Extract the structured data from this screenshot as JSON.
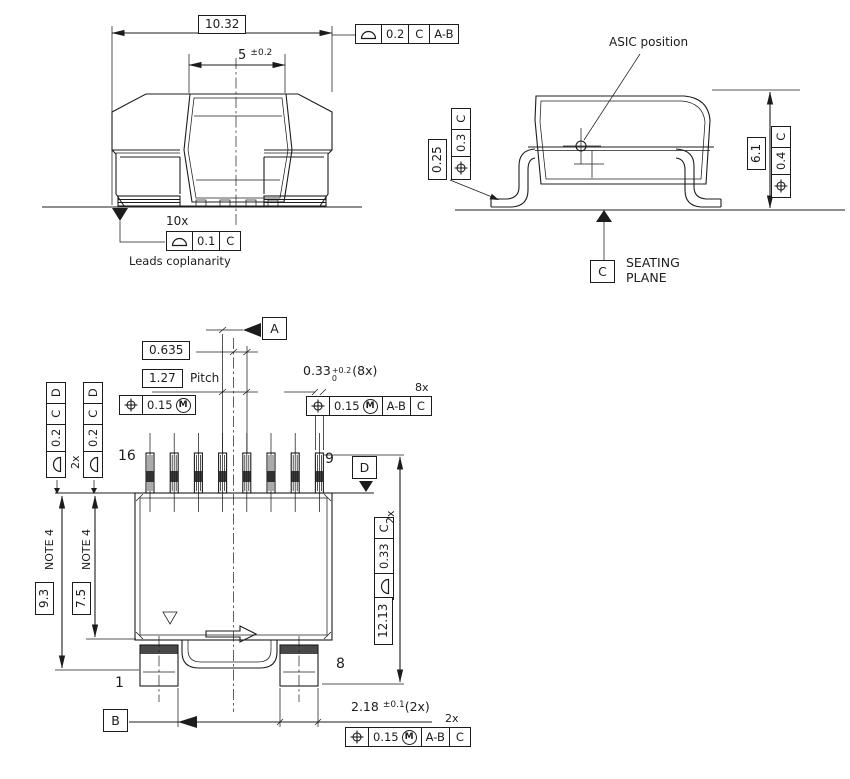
{
  "symbols": {
    "mmc": "M"
  },
  "front": {
    "dim_width": "10.32",
    "fcf_top": {
      "tol": "0.2",
      "d1": "C",
      "d2": "A-B"
    },
    "dim_cap": "5",
    "dim_cap_tol": "±0.2",
    "count_10x": "10x",
    "fcf_coplanarity": {
      "tol": "0.1",
      "d1": "C"
    },
    "caption": "Leads coplanarity"
  },
  "side": {
    "asic_label": "ASIC position",
    "dim_standoff": "0.25",
    "fcf_left": {
      "tol": "0.3",
      "d1": "C"
    },
    "dim_height": "6.1",
    "fcf_right": {
      "tol": "0.4",
      "d1": "C"
    },
    "datum_c": "C",
    "seating1": "SEATING",
    "seating2": "PLANE"
  },
  "top": {
    "datum_a": "A",
    "datum_b": "B",
    "datum_d": "D",
    "dim_offset": "0.635",
    "dim_pitch": "1.27",
    "pitch_label": "Pitch",
    "fcf_pitch": {
      "tol": "0.15"
    },
    "dim_lead": "0.33",
    "dim_lead_up": "+0.2",
    "dim_lead_dn": "0",
    "dim_lead_count": "(8x)",
    "count_8x": "8x",
    "fcf_lead": {
      "tol": "0.15",
      "d1": "A-B",
      "d2": "C"
    },
    "fcf_edge1": {
      "tol": "0.2",
      "d1": "C",
      "d2": "D"
    },
    "fcf_edge2": {
      "tol": "0.2",
      "d1": "C",
      "d2": "D"
    },
    "count_2x_left": "2x",
    "pin16": "16",
    "pin9": "9",
    "pin1": "1",
    "pin8": "8",
    "note4a": "NOTE 4",
    "note4b": "NOTE 4",
    "dim_93": "9.3",
    "dim_75": "7.5",
    "dim_1213": "12.13",
    "fcf_side": {
      "tol": "0.33",
      "d1": "C"
    },
    "count_2x_right": "2x",
    "dim_pad": "2.18",
    "dim_pad_tol": "±0.1",
    "dim_pad_count": "(2x)",
    "count_2x_bottom": "2x",
    "fcf_bottom": {
      "tol": "0.15",
      "d1": "A-B",
      "d2": "C"
    }
  }
}
